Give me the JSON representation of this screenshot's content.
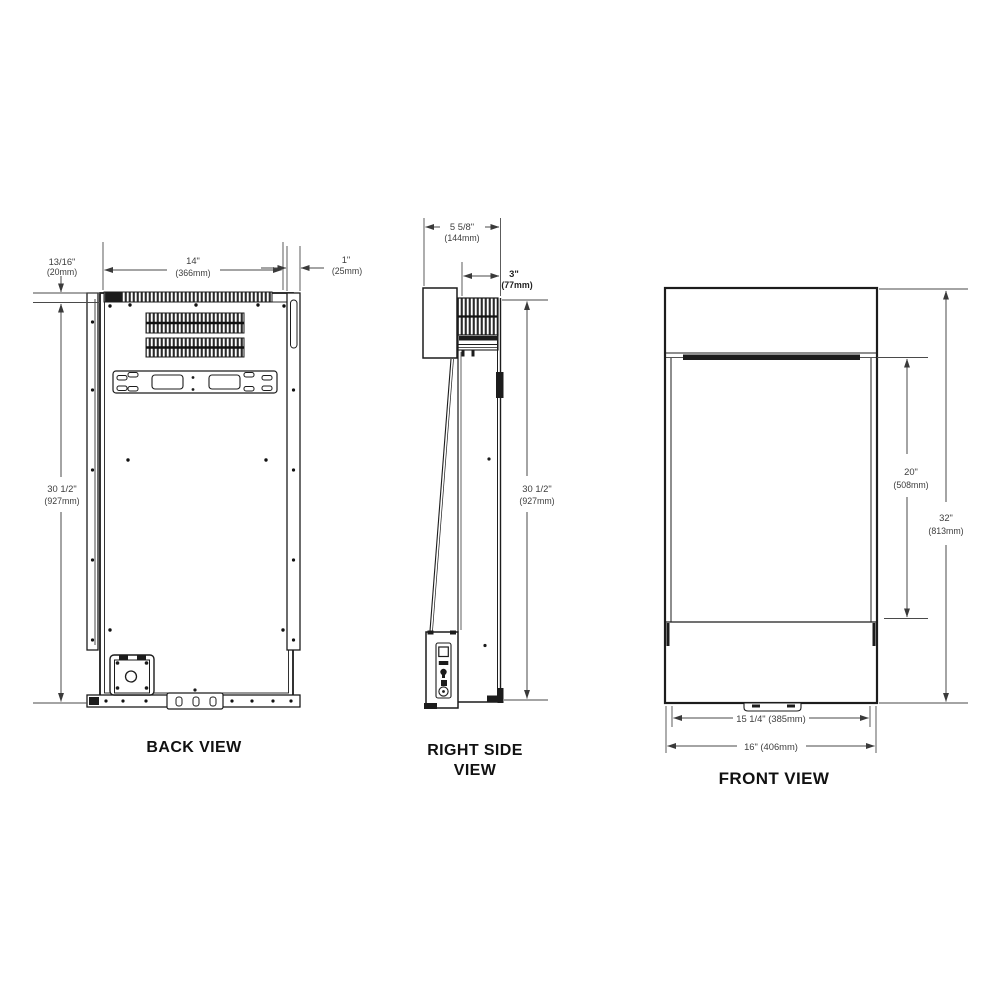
{
  "views": {
    "back": {
      "label": "BACK VIEW",
      "dim_offset_left": {
        "in": "13/16\"",
        "mm": "(20mm)"
      },
      "dim_width": {
        "in": "14\"",
        "mm": "(366mm)"
      },
      "dim_offset_right": {
        "in": "1\"",
        "mm": "(25mm)"
      },
      "dim_height": {
        "in": "30 1/2\"",
        "mm": "(927mm)"
      }
    },
    "side": {
      "label_line1": "RIGHT SIDE",
      "label_line2": "VIEW",
      "dim_depth": {
        "in": "5 5/8\"",
        "mm": "(144mm)"
      },
      "dim_front_depth": {
        "in": "3\"",
        "mm": "(77mm)"
      },
      "dim_height": {
        "in": "30 1/2\"",
        "mm": "(927mm)"
      }
    },
    "front": {
      "label": "FRONT VIEW",
      "dim_panel_height": {
        "in": "20\"",
        "mm": "(508mm)"
      },
      "dim_overall_height": {
        "in": "32\"",
        "mm": "(813mm)"
      },
      "dim_inner_width": "15 1/4\" (385mm)",
      "dim_overall_width": "16\" (406mm)"
    }
  },
  "colors": {
    "line": "#1c1c1c",
    "dimension": "#4a4a4a",
    "background": "#ffffff"
  }
}
